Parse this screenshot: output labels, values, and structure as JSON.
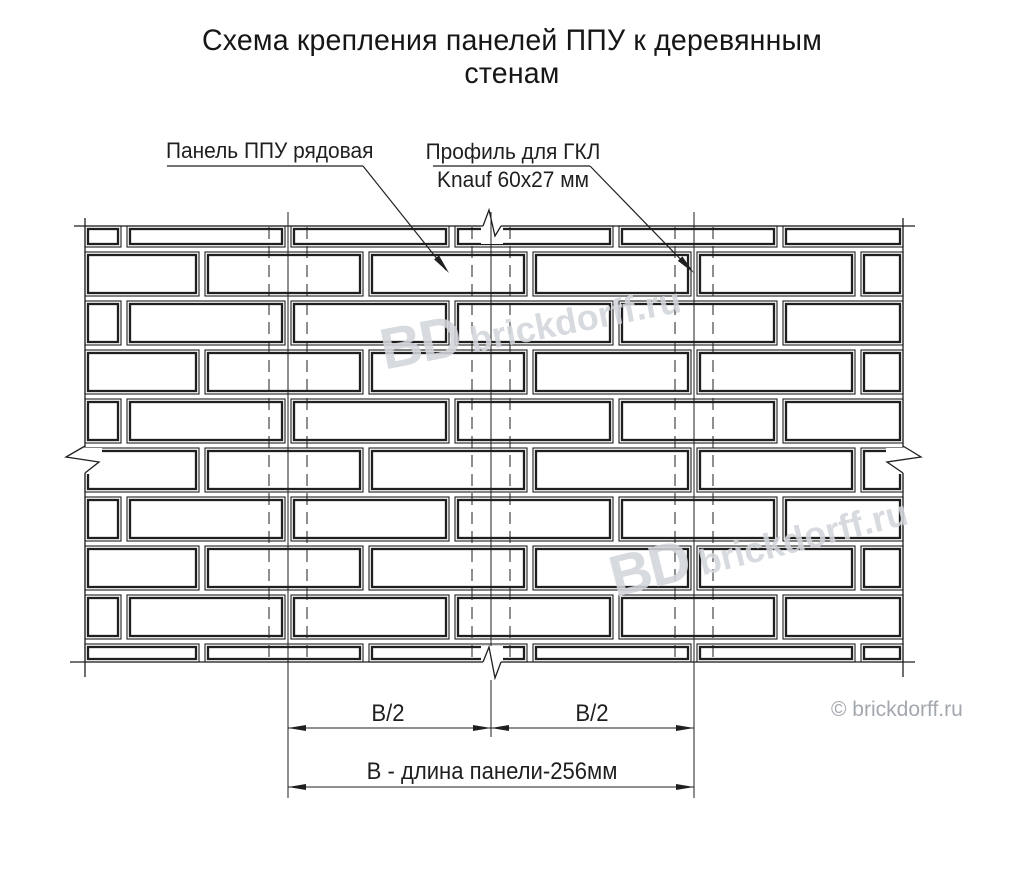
{
  "meta": {
    "background_color": "#ffffff",
    "line_color": "#1f1f1f",
    "watermark_color": "#d2d5da",
    "copyright_color": "#a3a7ae"
  },
  "title": {
    "line1": "Схема крепления панелей ППУ к деревянным",
    "line2": "стенам"
  },
  "labels": {
    "panel": {
      "text": "Панель ППУ рядовая"
    },
    "profile": {
      "line1": "Профиль для ГКЛ",
      "line2": "Knauf 60x27 мм"
    }
  },
  "dimensions": {
    "half_left": "В/2",
    "half_right": "В/2",
    "total": "В - длина панели-256мм"
  },
  "watermarks": {
    "bd": "BD",
    "site": "brickdorff.ru"
  },
  "copyright": "© brickdorff.ru"
}
